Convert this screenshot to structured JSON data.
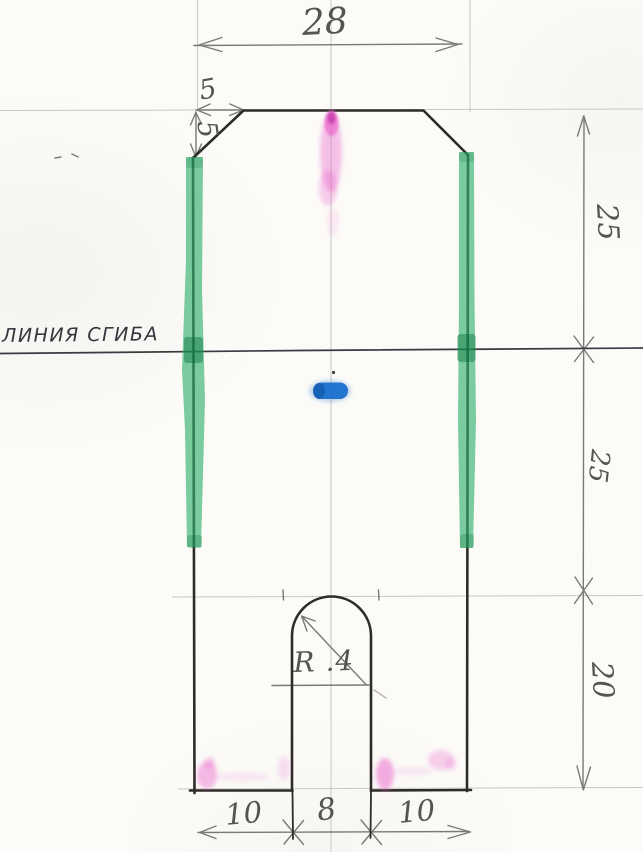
{
  "drawing": {
    "type": "hand-drawn sewing/craft pattern draft with fold line",
    "fold_line_label": "ЛИНИЯ СГИБА",
    "dims": {
      "top_width": "28",
      "chamfer_horizontal": "5",
      "chamfer_vertical": "5",
      "upper_half_height": "25",
      "lower_half_height": "25",
      "leg_height": "20",
      "slot_radius": "R .4",
      "bottom_left_leg": "10",
      "bottom_slot_width": "8",
      "bottom_right_leg": "10"
    },
    "colors": {
      "paper": "#fcfbf8",
      "pencil_dark": "#2e2c29",
      "pencil_mid": "#7b7975",
      "pencil_faint": "#c9c8c2",
      "fold": "#3b3a42",
      "highlight_green": "#31af6b",
      "highlight_green_dark": "#128549",
      "mark_pink": "#e960cb",
      "mark_blue": "#1b70cd"
    }
  }
}
